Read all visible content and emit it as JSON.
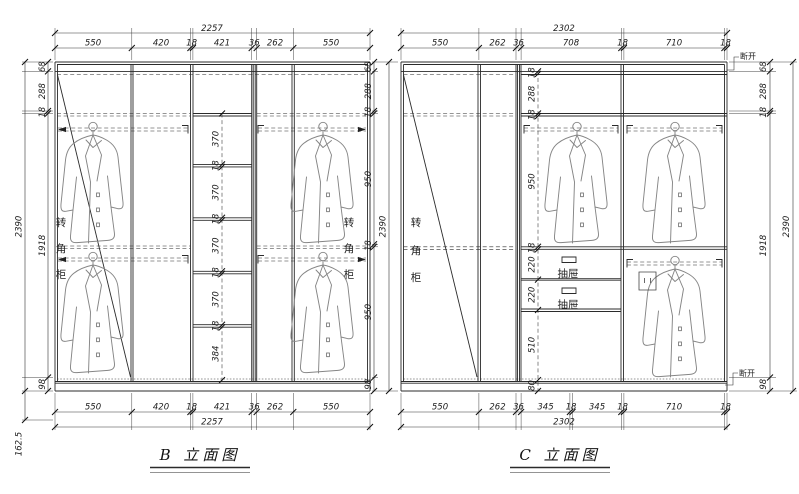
{
  "drawing": {
    "panel_b": {
      "title": "B 立面图",
      "overall_width": "2257",
      "overall_height": "2390",
      "top_dims": [
        "550",
        "420",
        "18",
        "421",
        "36",
        "262",
        "550"
      ],
      "bottom_dims": [
        "550",
        "420",
        "18",
        "421",
        "36",
        "262",
        "550"
      ],
      "left_chain": [
        "68",
        "288",
        "18",
        "1918",
        "98"
      ],
      "plinth_dim": "162.5",
      "right_chain": [
        "68",
        "288",
        "18",
        "950",
        "18",
        "950",
        "98"
      ],
      "center_chain": [
        "370",
        "18",
        "370",
        "18",
        "370",
        "18",
        "370",
        "18",
        "384"
      ],
      "corner_cabinet_chars": [
        "转",
        "角",
        "柜"
      ]
    },
    "panel_c": {
      "title": "C 立面图",
      "overall_width": "2302",
      "overall_height": "2390",
      "top_dims": [
        "550",
        "262",
        "36",
        "708",
        "18",
        "710",
        "18"
      ],
      "bottom_dims": [
        "550",
        "262",
        "36",
        "345",
        "18",
        "345",
        "18",
        "710",
        "18"
      ],
      "right_chain": [
        "68",
        "288",
        "18",
        "1918",
        "98"
      ],
      "center_chain": [
        "18",
        "288",
        "18",
        "950",
        "18",
        "220",
        "220",
        "510",
        "80"
      ],
      "drawer_label": "抽屉",
      "break_label": "断开",
      "corner_cabinet_chars": [
        "转",
        "角",
        "柜"
      ]
    }
  }
}
